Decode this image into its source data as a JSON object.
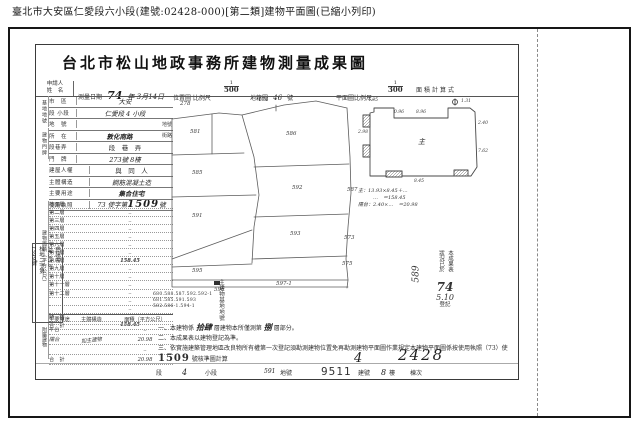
{
  "page_title": "臺北市大安區仁愛段六小段(建號:02428-000)[第二類]建物平面圖(已縮小列印)",
  "doc": {
    "heading": "台北市松山地政事務所建物測量成果圖",
    "header": {
      "applicant_l1": "申請人",
      "applicant_l2": "姓　名",
      "survey_label": "測量日期",
      "survey_year": "74",
      "survey_rest": "年 3月14日",
      "loc_label": "位置圖 比例尺",
      "loc_num": "1",
      "loc_den": "500",
      "sheet_label": "地籍圖",
      "sheet_no": "46",
      "sheet_suffix": "號",
      "plan_label": "平面圖比例尺：",
      "plan_num": "1",
      "plan_den": "300",
      "calc_label": "面積計算式"
    },
    "form": {
      "group_base": "基地地號",
      "group_door": "建物門牌",
      "r1_label": "市　區",
      "r1_value": "大安",
      "r2_label": "段 小段",
      "r2_value": "仁愛段 4 小段",
      "r3_label": "地　號",
      "r3_value": "",
      "r3_suffix": "地號",
      "r4_label": "所　在",
      "r4_value": "敦化南路",
      "r4_suffix": "街路",
      "r5_label": "段巷弄",
      "r5_value": "段　巷　弄",
      "r6_label": "門　牌",
      "r6_value": "273號 8樓",
      "r7_label": "建屋人權",
      "r7_value": "與　同　人",
      "r8_label": "主體構造",
      "r8_value": "鋼筋混凝土造",
      "r9_label": "主要用途",
      "r9_value": "集合住宅",
      "license_label": "使用執照",
      "license_pre": "73 使字第",
      "license_no": "1509",
      "license_suf": "號"
    },
    "floor_table": {
      "side_label": "建物面積（平方公尺）",
      "rows": [
        {
          "label": "地面層",
          "value": "‥"
        },
        {
          "label": "第二層",
          "value": "‥"
        },
        {
          "label": "第三層",
          "value": "‥"
        },
        {
          "label": "第四層",
          "value": "‥"
        },
        {
          "label": "第五層",
          "value": "‥"
        },
        {
          "label": "第六層",
          "value": "‥"
        },
        {
          "label": "第七層",
          "value": "‥"
        },
        {
          "label": "第八層",
          "value": "158.45"
        },
        {
          "label": "第九層",
          "value": "‥"
        },
        {
          "label": "第十層",
          "value": "‥"
        },
        {
          "label": "第十一層",
          "value": "‥"
        },
        {
          "label": "第十二層",
          "value": "‥"
        },
        {
          "label": "",
          "value": "‥"
        },
        {
          "label": "",
          "value": "‥"
        },
        {
          "label": "騎　樓",
          "value": "‥"
        },
        {
          "label": "合　計",
          "value": "158.45"
        }
      ]
    },
    "annex_table": {
      "side_label": "附屬建物",
      "headers": [
        "主要用途",
        "主體構造",
        "面積（平方公尺）"
      ],
      "rows": [
        {
          "use": "平台",
          "structure": "",
          "area": "‥"
        },
        {
          "use": "陽台",
          "structure": "如主建物",
          "area": "20.98"
        },
        {
          "use": "",
          "structure": "",
          "area": "‥"
        },
        {
          "use": "合　計",
          "structure": "",
          "area": "20.98"
        }
      ]
    },
    "map": {
      "labels": [
        "278",
        "174",
        "581",
        "586",
        "585",
        "592",
        "587",
        "591",
        "593",
        "595",
        "596",
        "597-1",
        "575",
        "573"
      ]
    },
    "plan": {
      "dims": [
        "4.05",
        "0.96",
        "8.96",
        "1.31",
        "2.40",
        "7.62",
        "2.98",
        "8.45"
      ],
      "main_mark": "主",
      "formulas": [
        "主：13.93×8.45＋…",
        "　　　…　＝158.45",
        "陽台：2.40×…　＝20.98"
      ]
    },
    "stamps": {
      "app_l1": "申請書",
      "app_l2": "74.3.13",
      "app_l3": "松地二字第",
      "app_l4": "1599號",
      "lot_line1": "680.588.587.592.592-1",
      "lot_line2": "681.585.591.593",
      "lot_line3": "582.586-1.594-1",
      "lot_label": "主建物基地地號",
      "reg_col1": "本成果表",
      "reg_col2": "狀況已於",
      "reg_year": "74",
      "reg_md": "5.10",
      "reg_suffix": "登記",
      "reg_side": "589"
    },
    "notes": {
      "n1_pre": "一、本建物係",
      "n1_hand1": "拾肆",
      "n1_mid": "層建物本所僅測第",
      "n1_hand2": "捌",
      "n1_suf": "層部分。",
      "n2": "二、本成果表以建物登記為準。",
      "n3_pre": "三、依實施建築管理地區改良物所有權第一次登記須勘測建物位置免再勘測建物平面圖作業規定本建物平面圖係按使用執照（73）使",
      "n3_no": "1509",
      "n3_suf": "號核準圖計算"
    },
    "handwritten": {
      "n1": "4",
      "n2": "2428"
    },
    "bottom": {
      "sec": "段",
      "sec_v": "4",
      "sub": "小段",
      "lot_v": "591",
      "lot": "地號",
      "bno_v": "9511",
      "bno": "建號",
      "fl_v": "8",
      "fl": "樓",
      "unit": "棟次"
    }
  }
}
